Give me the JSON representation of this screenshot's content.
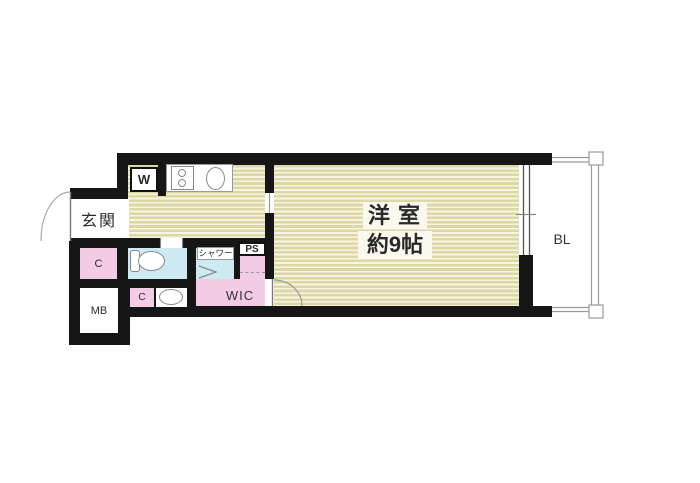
{
  "floor_plan": {
    "rooms": {
      "main_room": {
        "name": "洋室",
        "size": "約9帖"
      },
      "entrance": {
        "label": "玄関"
      },
      "balcony": {
        "label": "BL"
      },
      "walk_in_closet": {
        "label": "WIC"
      },
      "shower": {
        "label": "シャワー"
      },
      "pipe_space": {
        "label": "PS"
      },
      "washer": {
        "label": "W"
      },
      "closet_upper": {
        "label": "C"
      },
      "closet_lower": {
        "label": "C"
      },
      "meter_box": {
        "label": "MB"
      }
    },
    "colors": {
      "wall": "#161616",
      "floor_stripe_base": "#dcd8a6",
      "floor_stripe_light": "#f7f4e3",
      "closet_pink": "#f4cbe4",
      "wet_area_blue": "#cdeaf2",
      "fixture_line_gray": "#888888",
      "text": "#2a2a2a",
      "background": "#ffffff"
    }
  }
}
